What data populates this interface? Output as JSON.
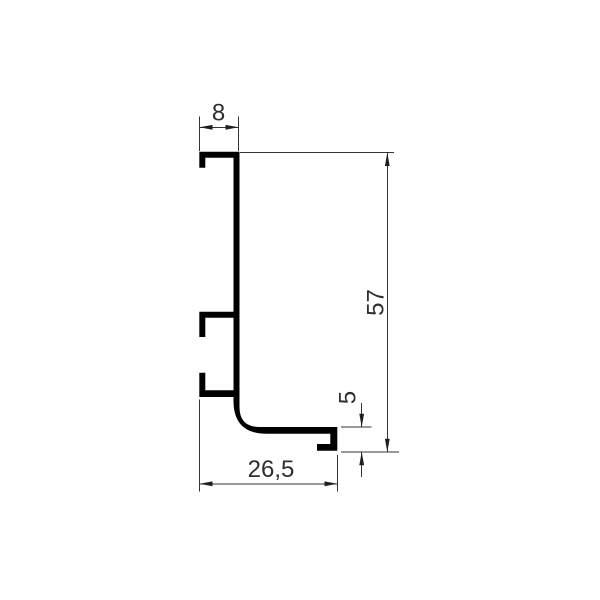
{
  "drawing": {
    "description": "Dimensioned cross-section technical drawing of an L-shaped profile with mounting hooks",
    "labels": {
      "top_width": "8",
      "overall_height": "57",
      "end_lip_height": "5",
      "bottom_width": "26,5"
    },
    "colors": {
      "profile": "#000000",
      "dimension_lines": "#333333",
      "dimension_text": "#2e2e2e",
      "background": "#ffffff"
    }
  }
}
